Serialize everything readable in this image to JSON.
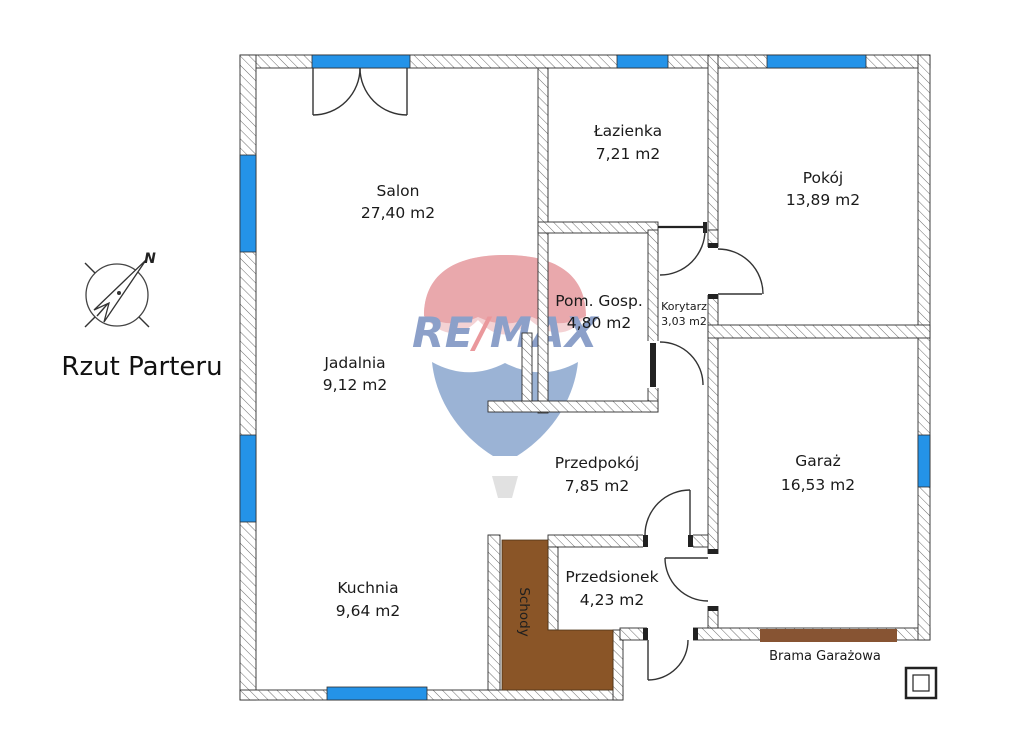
{
  "title": "Rzut Parteru",
  "compass": {
    "north_label": "N"
  },
  "watermark": {
    "part1": "RE",
    "slash": "/",
    "part2": "MAX"
  },
  "rooms": {
    "salon": {
      "name": "Salon",
      "area": "27,40 m2"
    },
    "jadalnia": {
      "name": "Jadalnia",
      "area": "9,12 m2"
    },
    "kuchnia": {
      "name": "Kuchnia",
      "area": "9,64 m2"
    },
    "lazienka": {
      "name": "Łazienka",
      "area": "7,21 m2"
    },
    "pom_gosp": {
      "name": "Pom. Gosp.",
      "area": "4,80 m2"
    },
    "korytarz": {
      "name": "Korytarz",
      "area": "3,03 m2"
    },
    "pokoj": {
      "name": "Pokój",
      "area": "13,89 m2"
    },
    "przedpokoj": {
      "name": "Przedpokój",
      "area": "7,85 m2"
    },
    "przedsionek": {
      "name": "Przedsionek",
      "area": "4,23 m2"
    },
    "garaz": {
      "name": "Garaż",
      "area": "16,53 m2"
    }
  },
  "labels": {
    "stairs": "Schody",
    "garage_door": "Brama Garażowa"
  },
  "colors": {
    "window": "#2493e8",
    "stairs": "#8a5527",
    "garage_door": "#875433",
    "balloon_red": "#d5535c",
    "balloon_red_light": "#eaa6ab",
    "balloon_blue": "#3a69ad",
    "basket": "#c4c4c4",
    "remax_blue": "#1c4495",
    "remax_red": "#d6343c"
  }
}
